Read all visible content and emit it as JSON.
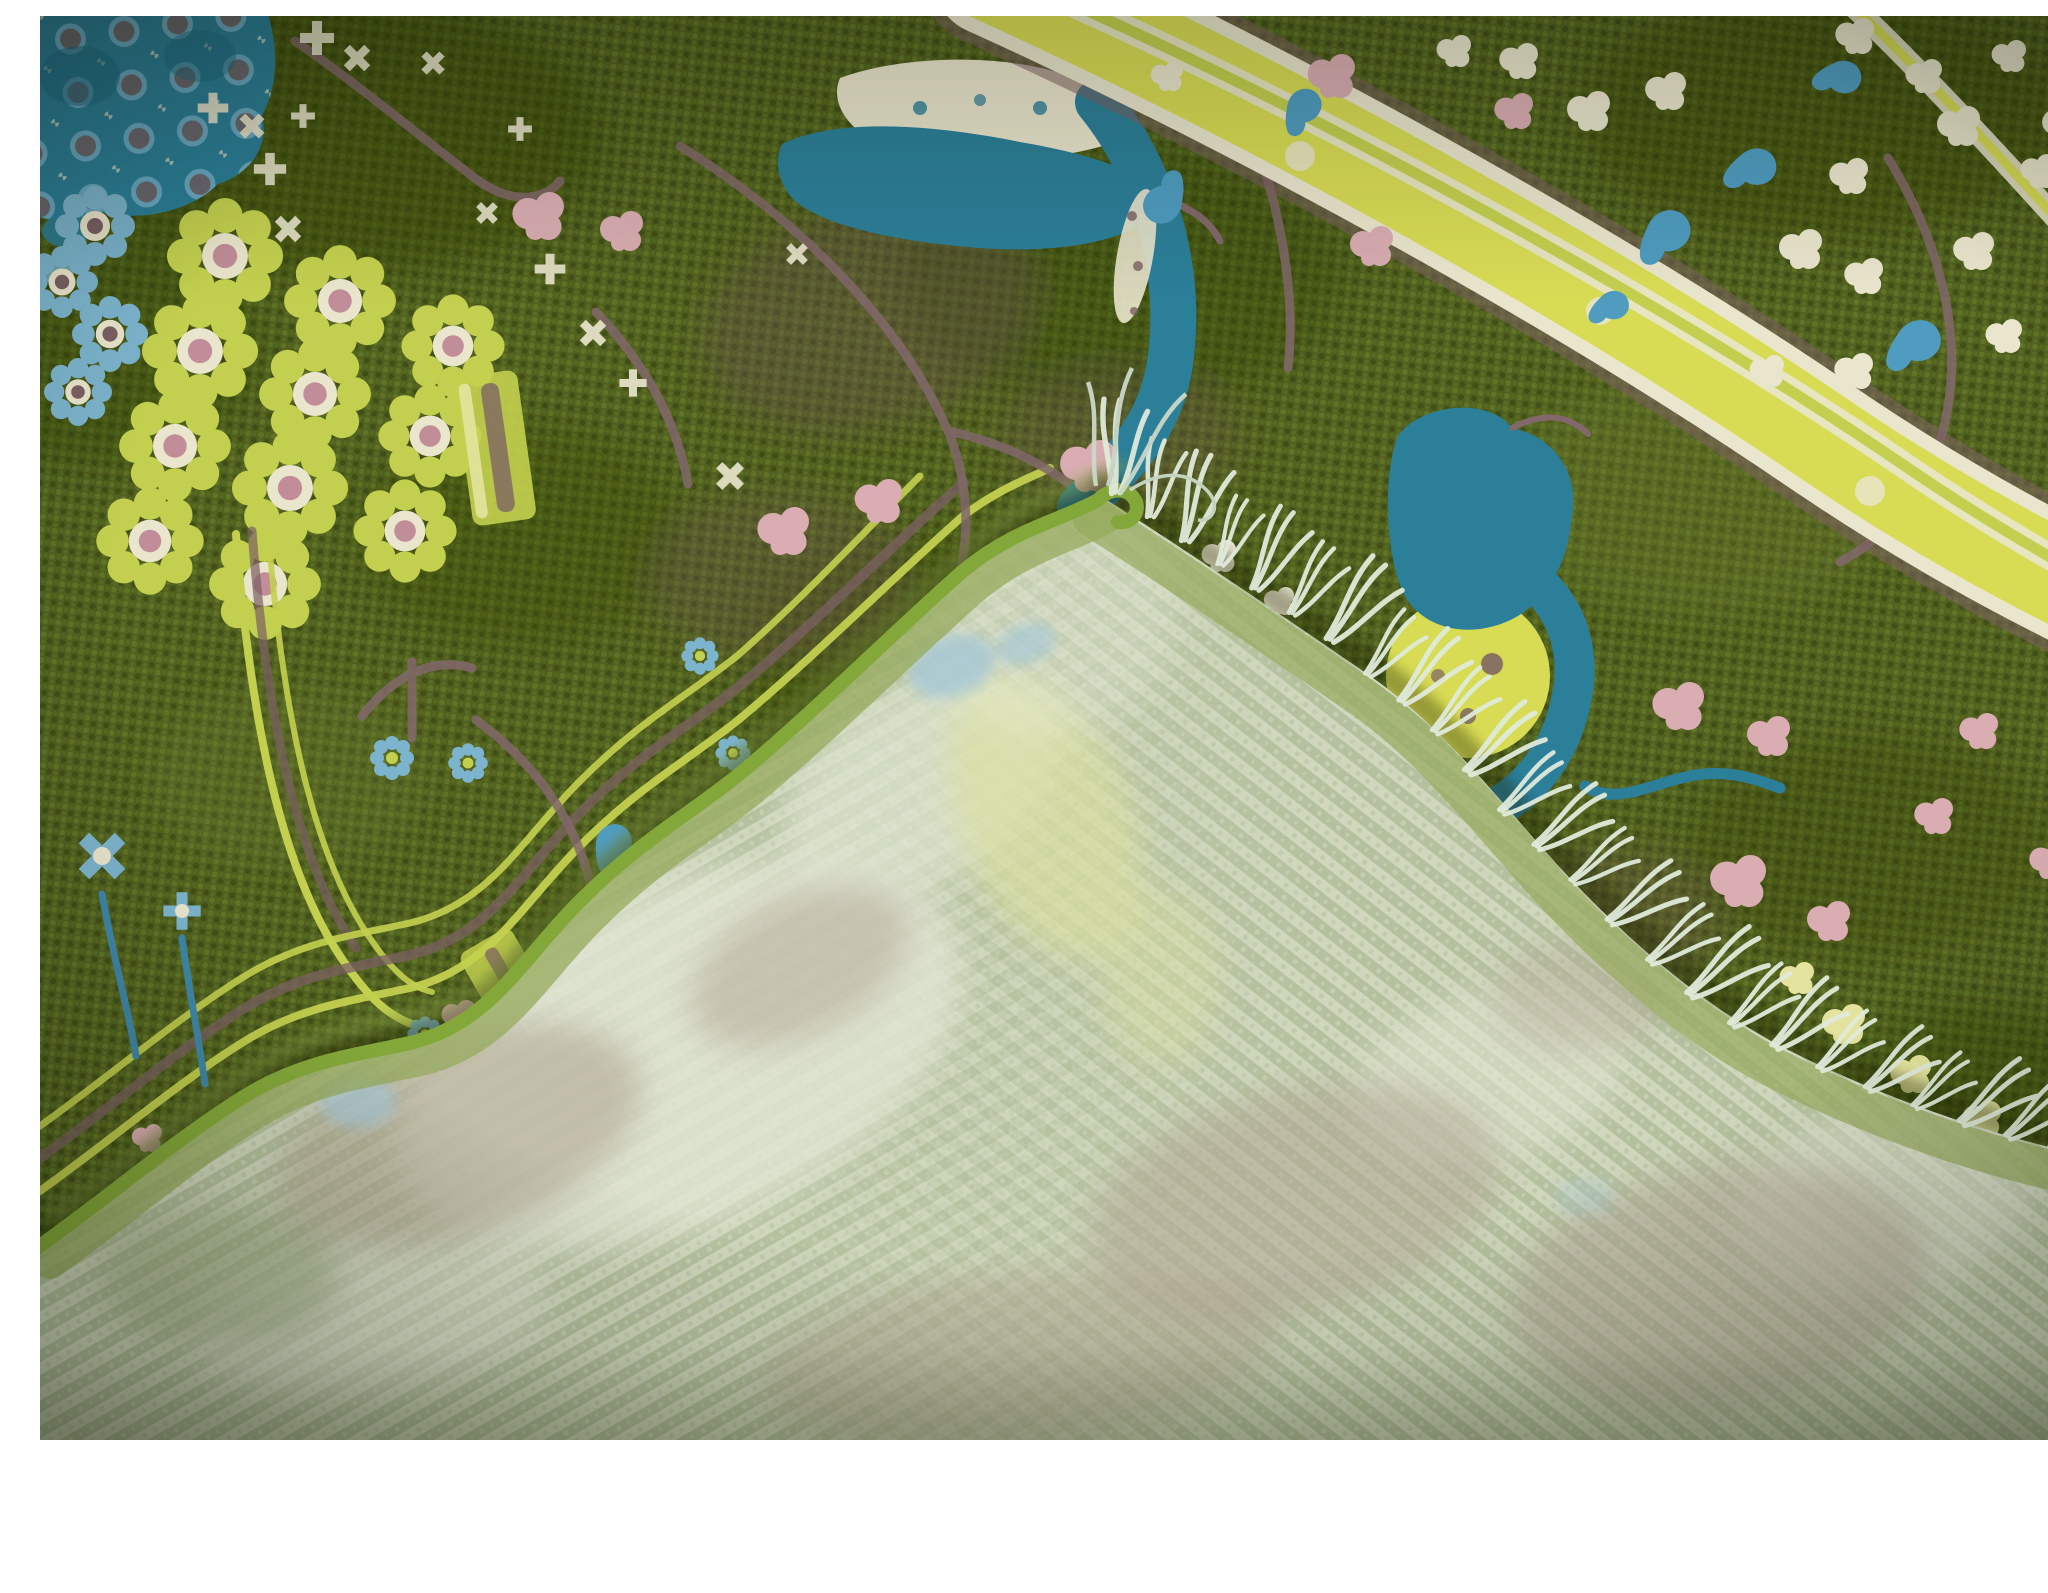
{
  "meta": {
    "description": "Close-up product photograph of a moss-green hand-knotted wool rug with a colorful floral and bird pattern; its corner is folded over, revealing the pale sage flat-woven back and white fringe tassels, on a white background."
  },
  "palette": {
    "photo_white": "#ffffff",
    "face_green": "#50601f",
    "face_knot_light": "#72852e",
    "face_knot_mid": "#5d7026",
    "face_knot_dark": "#35420e",
    "teal": "#2c7f99",
    "teal_dark": "#1d6a82",
    "light_blue": "#7cb4cd",
    "paisley_blue": "#4f9cc0",
    "stem_blue": "#3f86a8",
    "cream": "#eae5cd",
    "pink": "#d9adb2",
    "pink_deep": "#c18d98",
    "mauve": "#7b6063",
    "branch_brown": "#82686b",
    "chartreuse": "#c3d04f",
    "band_yellow": "#d8dc55",
    "pale_yellow": "#e3e39e",
    "selvage_green": "#84a73a",
    "face_edge_light": "#8aa348",
    "back_base": "#c5ceb2",
    "back_row_light": "#d9e0c8",
    "back_row_dark": "#a2b287",
    "back_tan": "#b1a693",
    "back_cream": "#e1e6d4",
    "back_blue": "#a8c8d5",
    "back_yellow": "#dce19f",
    "back_edge_green": "#95a95c",
    "fringe": "#e0eadb",
    "fringe_dim": "#cbd9c8"
  },
  "scene": {
    "subject": "Green Oushak-style wool rug, corner folded to show woven back and fringe",
    "front_motifs": [
      "teal honeycomb medallion",
      "chartreuse rosette cluster",
      "teal birds",
      "yellow diagonal border band",
      "pink blossoms",
      "cream star flowers",
      "blue paisleys",
      "brown branches",
      "blue daisies"
    ],
    "fold": {
      "side": "back of rug",
      "texture": "flat-woven pale sage with ghost pattern",
      "fringe_tassels": 25
    },
    "background_area": "white strip along bottom edge"
  }
}
